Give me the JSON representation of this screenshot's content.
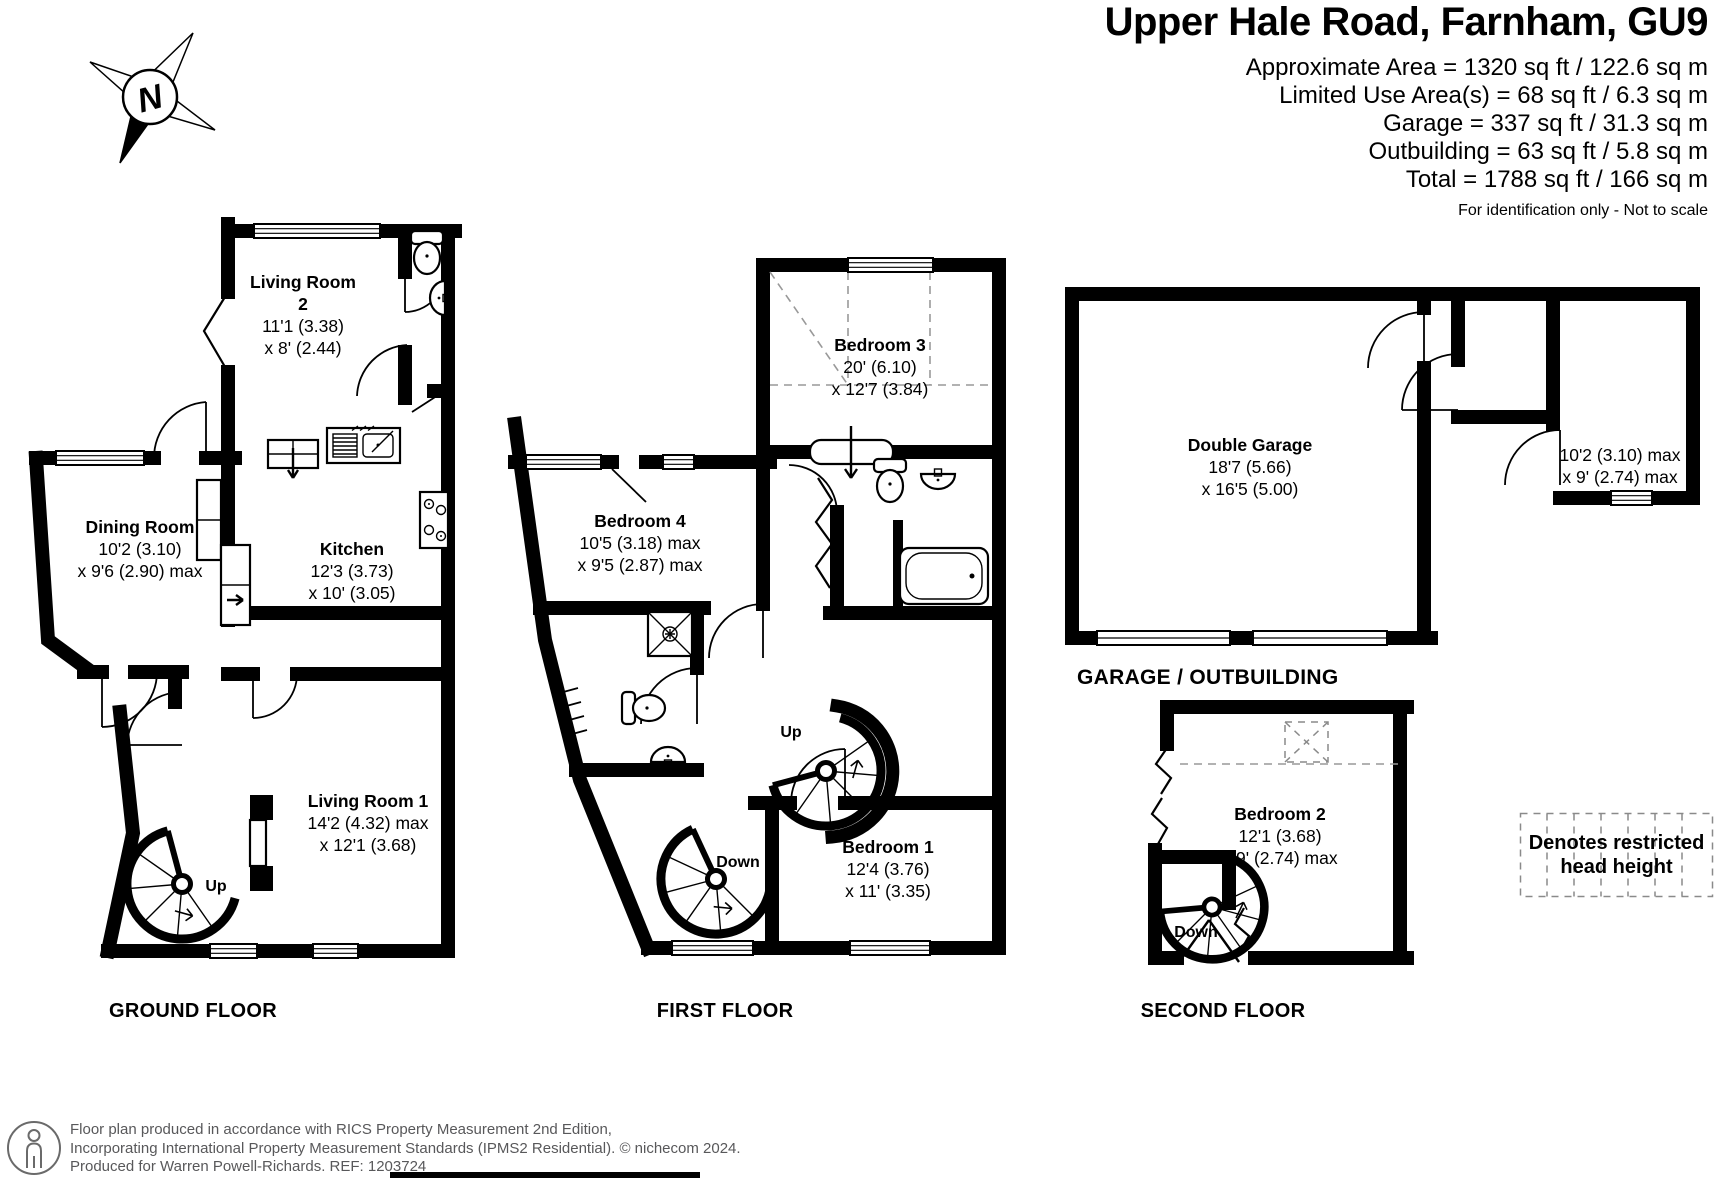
{
  "header": {
    "title": "Upper Hale Road, Farnham, GU9",
    "area_lines": [
      "Approximate Area = 1320 sq ft / 122.6 sq m",
      "Limited Use Area(s) = 68 sq ft / 6.3 sq m",
      "Garage = 337 sq ft / 31.3 sq m",
      "Outbuilding = 63 sq ft / 5.8 sq m",
      "Total = 1788 sq ft / 166 sq m"
    ],
    "disclaimer": "For identification only - Not to scale"
  },
  "compass": {
    "north": "N"
  },
  "floors": {
    "ground": {
      "label": "GROUND FLOOR",
      "stair_up": "Up",
      "rooms": {
        "living_room_2": {
          "lines": [
            "Living Room",
            "2",
            "11'1 (3.38)",
            "x 8' (2.44)"
          ]
        },
        "dining_room": {
          "lines": [
            "Dining Room",
            "10'2 (3.10)",
            "x 9'6 (2.90) max"
          ]
        },
        "kitchen": {
          "lines": [
            "Kitchen",
            "12'3 (3.73)",
            "x 10' (3.05)"
          ]
        },
        "living_room_1": {
          "lines": [
            "Living Room 1",
            "14'2 (4.32) max",
            "x 12'1 (3.68)"
          ]
        }
      }
    },
    "first": {
      "label": "FIRST FLOOR",
      "stair_up": "Up",
      "stair_down": "Down",
      "rooms": {
        "bedroom_3": {
          "lines": [
            "Bedroom 3",
            "20' (6.10)",
            "x 12'7 (3.84)"
          ]
        },
        "bedroom_4": {
          "lines": [
            "Bedroom 4",
            "10'5 (3.18) max",
            "x 9'5 (2.87) max"
          ]
        },
        "bedroom_1": {
          "lines": [
            "Bedroom 1",
            "12'4 (3.76)",
            "x 11' (3.35)"
          ]
        }
      }
    },
    "second": {
      "label": "SECOND FLOOR",
      "stair_down": "Down",
      "rooms": {
        "bedroom_2": {
          "lines": [
            "Bedroom 2",
            "12'1 (3.68)",
            "x 9' (2.74) max"
          ]
        }
      }
    },
    "garage": {
      "section_label": "GARAGE / OUTBUILDING",
      "rooms": {
        "double_garage": {
          "lines": [
            "Double Garage",
            "18'7 (5.66)",
            "x 16'5 (5.00)"
          ]
        },
        "store": {
          "lines": [
            "10'2 (3.10) max",
            "x 9' (2.74) max"
          ]
        }
      }
    }
  },
  "legend": {
    "lines": [
      "Denotes restricted",
      "head height"
    ]
  },
  "footer": {
    "lines": [
      "Floor plan produced in accordance with RICS Property Measurement 2nd Edition,",
      "Incorporating International Property Measurement Standards (IPMS2 Residential).   © nichecom 2024.",
      "Produced for Warren Powell-Richards.   REF: 1203724"
    ]
  }
}
